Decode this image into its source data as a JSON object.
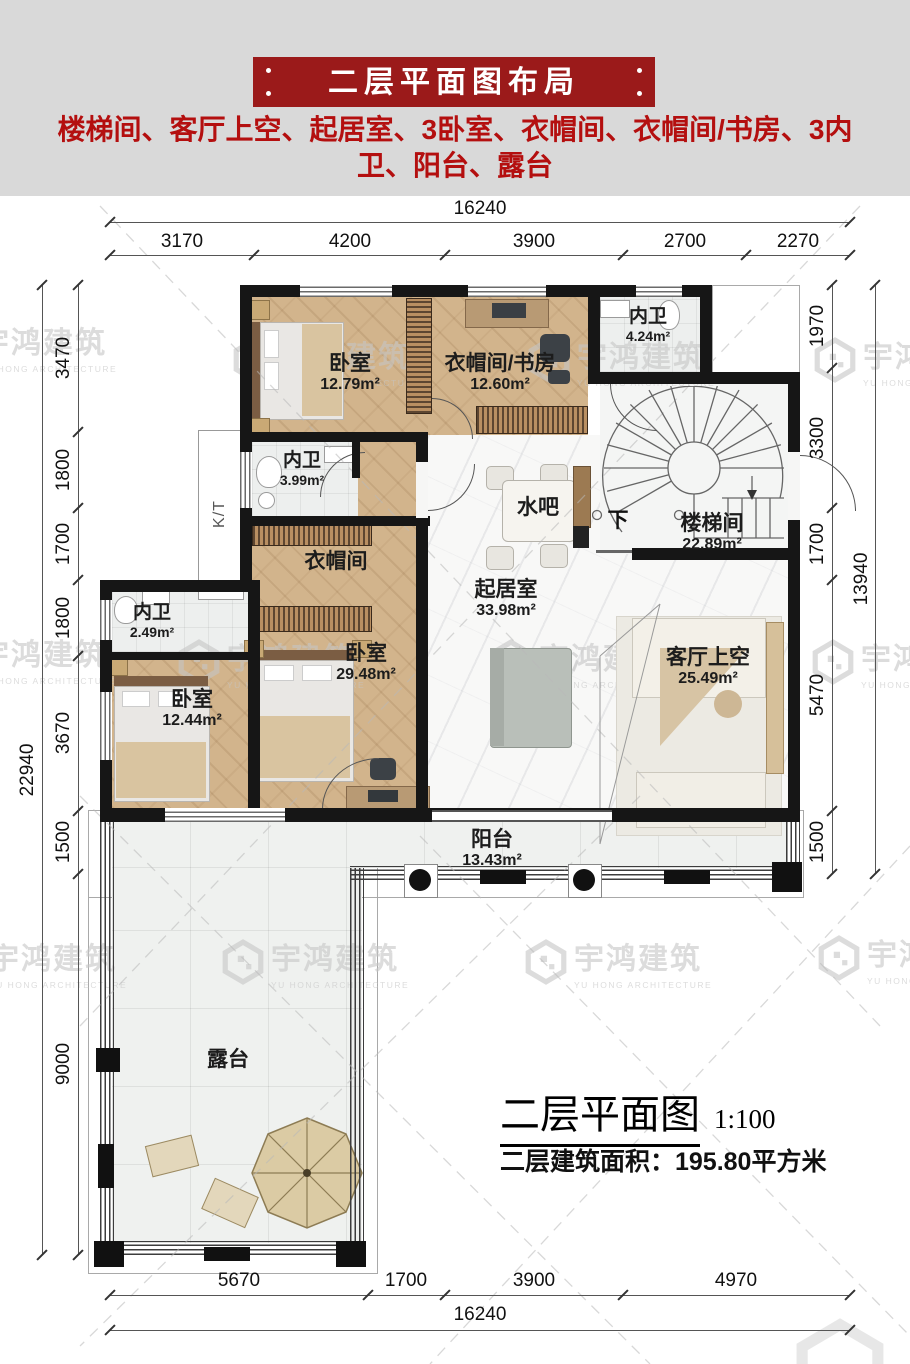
{
  "header": {
    "title": "二层平面图布局",
    "subtitle": "楼梯间、客厅上空、起居室、3卧室、衣帽间、衣帽间/书房、3内卫、阳台、露台"
  },
  "colors": {
    "banner_red": "#9b1a1a",
    "subtitle_red": "#b40f0f",
    "wall": "#161616",
    "wood_floor": "#d2b48c",
    "tile_floor": "#edefee",
    "marble_floor": "#f8f8f7"
  },
  "watermark": {
    "cn": "宇鸿建筑",
    "en": "YU HONG ARCHITECTURE"
  },
  "rooms": [
    {
      "name": "卧室",
      "area": "12.79m²"
    },
    {
      "name": "衣帽间/书房",
      "area": "12.60m²"
    },
    {
      "name": "内卫",
      "area": "4.24m²"
    },
    {
      "name": "楼梯间",
      "area": "22.89m²"
    },
    {
      "name": "内卫",
      "area": "3.99m²"
    },
    {
      "name": "衣帽间",
      "area": ""
    },
    {
      "name": "水吧",
      "area": ""
    },
    {
      "name": "起居室",
      "area": "33.98m²"
    },
    {
      "name": "内卫",
      "area": "2.49m²"
    },
    {
      "name": "卧室",
      "area": "12.44m²"
    },
    {
      "name": "卧室",
      "area": "29.48m²"
    },
    {
      "name": "客厅上空",
      "area": "25.49m²"
    },
    {
      "name": "阳台",
      "area": "13.43m²"
    },
    {
      "name": "露台",
      "area": ""
    }
  ],
  "annotations": {
    "down": "下",
    "kt": "K/T"
  },
  "dimensions": {
    "top_total": "16240",
    "top_segments": [
      "3170",
      "4200",
      "3900",
      "2700",
      "2270"
    ],
    "left_total": "22940",
    "left_segments": [
      "3470",
      "1800",
      "1700",
      "1800",
      "3670",
      "1500",
      "9000"
    ],
    "right_total": "13940",
    "right_segments": [
      "1970",
      "3300",
      "1700",
      "5470",
      "1500"
    ],
    "bottom_segments": [
      "5670",
      "1700",
      "3900",
      "4970"
    ],
    "bottom_total": "16240"
  },
  "footer": {
    "plan_title": "二层平面图",
    "scale": "1:100",
    "area_note": "二层建筑面积：195.80平方米"
  }
}
